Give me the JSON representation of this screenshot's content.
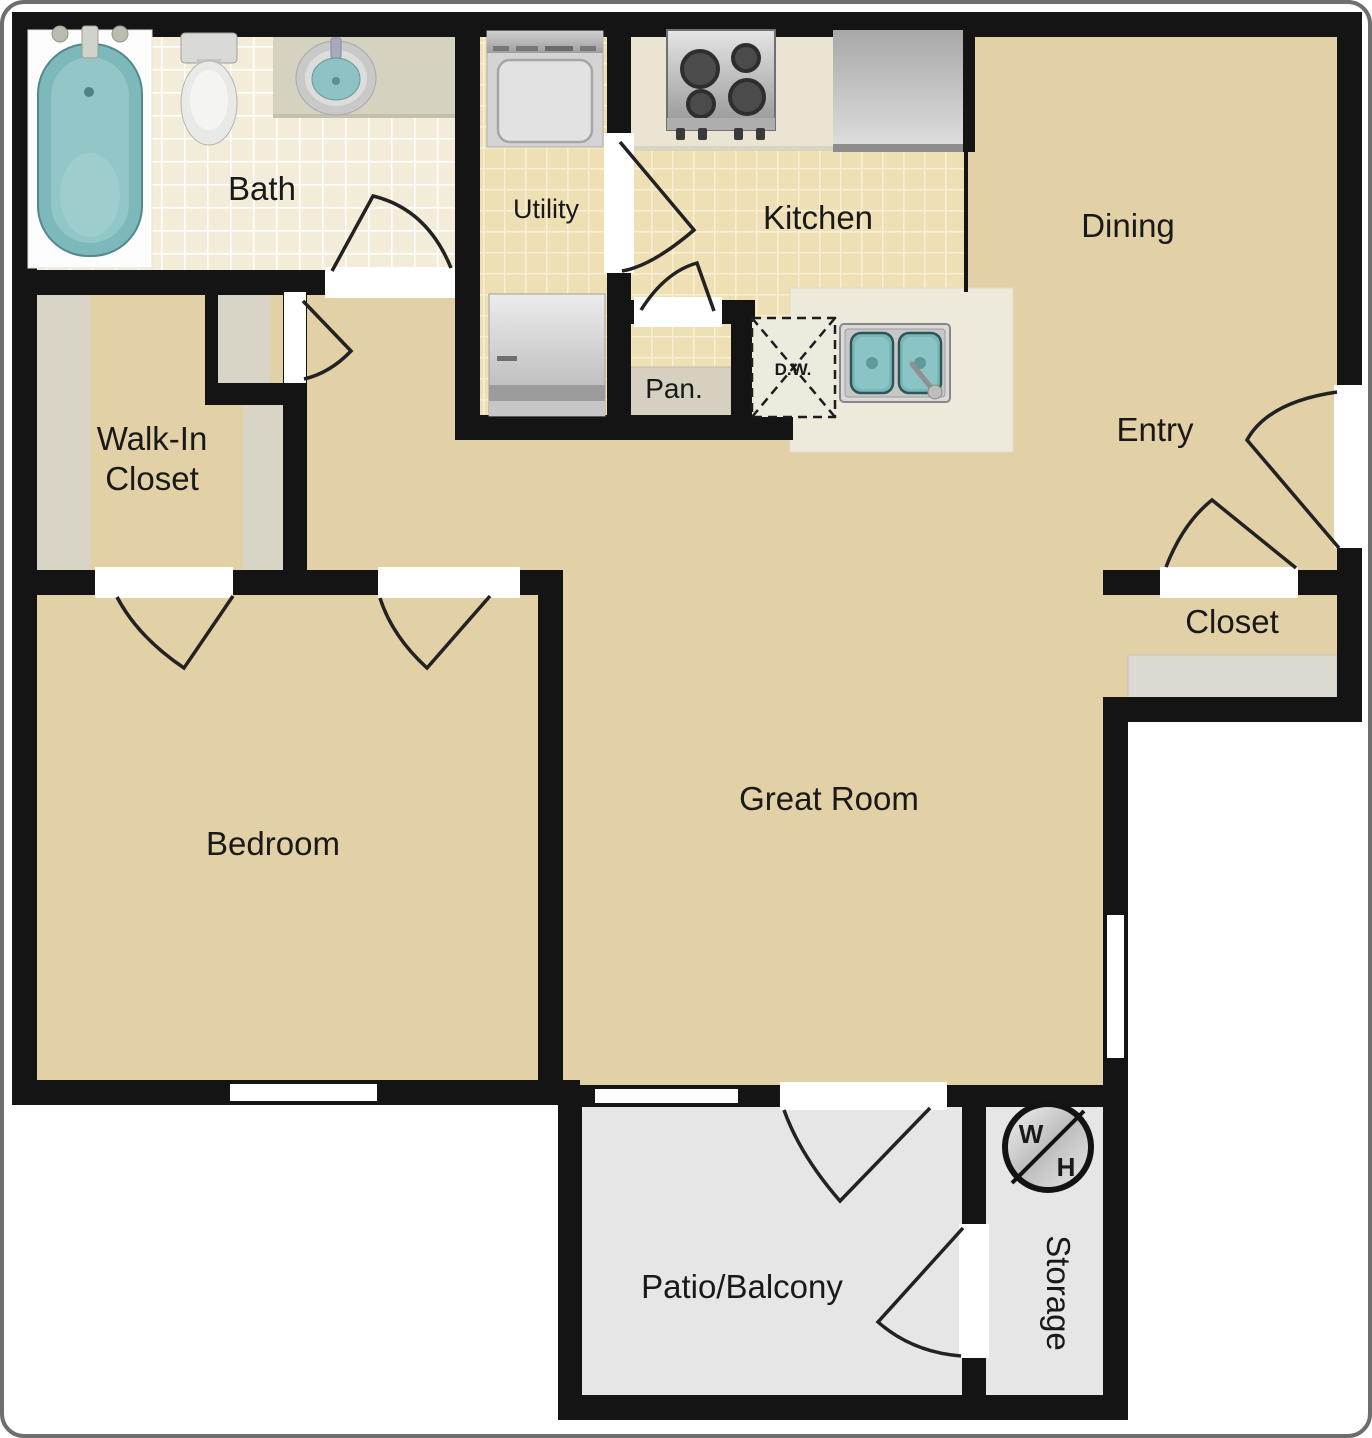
{
  "floor_plan": {
    "labels": {
      "bath": "Bath",
      "utility": "Utility",
      "kitchen": "Kitchen",
      "dining": "Dining",
      "entry": "Entry",
      "entry_closet": "Closet",
      "walk_in_closet_line1": "Walk-In",
      "walk_in_closet_line2": "Closet",
      "pantry": "Pan.",
      "dishwasher": "D.W.",
      "bedroom": "Bedroom",
      "great_room": "Great Room",
      "patio_balcony": "Patio/Balcony",
      "storage": "Storage",
      "water_heater_w": "W",
      "water_heater_h": "H"
    },
    "colors": {
      "walls": "#141414",
      "room_floor": "#e2d1a6",
      "kitchen_tile": "#eedfb5",
      "bath_tile": "#f3ecd9",
      "patio_floor": "#e6e6e7",
      "shelving": "#d8d5c7",
      "counters": "#edeadb",
      "fixtures_teal": "#7db8ba",
      "outside": "#ffffff"
    }
  }
}
